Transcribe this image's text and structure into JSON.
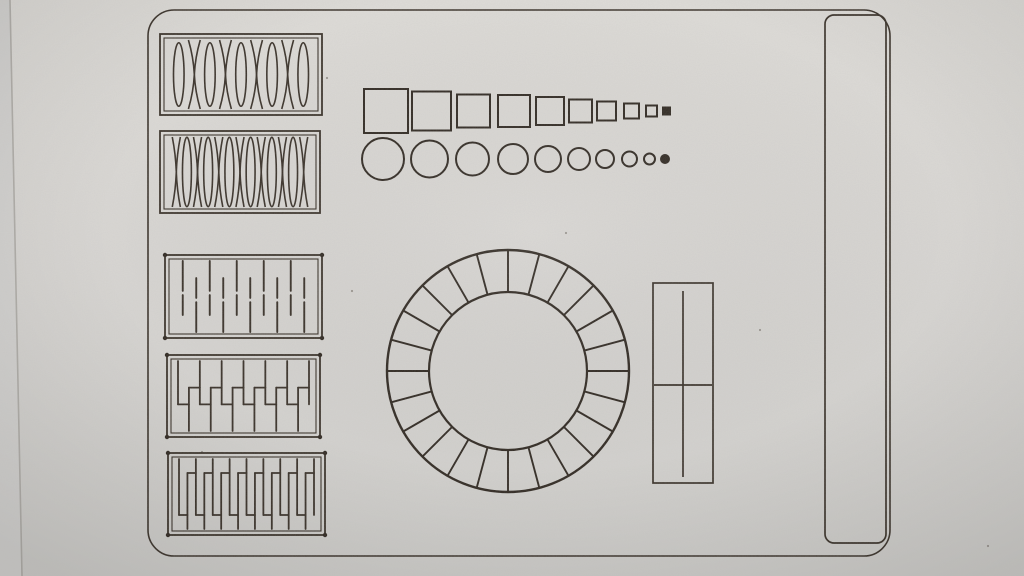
{
  "meta": {
    "description": "Photograph of a laser-cut and engraved calibration test sheet on light grey material: five living-hinge test panels, rows of shrinking squares and circles, a 24-segment ring, a divided rectangle and a tall rounded rectangle",
    "colors": {
      "material_top": "#dedcd8",
      "material_mid": "#d8d6d3",
      "material_bottom": "#cfcecb",
      "outside_strip": "#d4d3d1",
      "edge_line": "#a8a5a0",
      "line": "#3a322a",
      "line_bold": "#312a23",
      "speck": "#8a857e"
    }
  },
  "scene": {
    "canvas": {
      "width": 1024,
      "height": 576
    },
    "photo": {
      "sheet_edge": {
        "top_x": 10,
        "bottom_x": 22
      },
      "specks": [
        {
          "x": 327,
          "y": 78
        },
        {
          "x": 202,
          "y": 452
        },
        {
          "x": 566,
          "y": 233
        },
        {
          "x": 352,
          "y": 291
        },
        {
          "x": 760,
          "y": 330
        },
        {
          "x": 988,
          "y": 546
        }
      ]
    },
    "board": {
      "x": 148,
      "y": 10,
      "width": 742,
      "height": 546,
      "radius": 26,
      "stroke_width": 1.6
    },
    "left_column": {
      "hinge_panels": [
        {
          "name": "hinge-panel-ellipse-cross",
          "pattern": "ellipse-cross",
          "x": 160,
          "y": 34,
          "width": 162,
          "height": 81,
          "units": 9,
          "corner_dots": false
        },
        {
          "name": "hinge-panel-cross-ellipse",
          "pattern": "cross-ellipse",
          "x": 160,
          "y": 131,
          "width": 160,
          "height": 82,
          "units": 13,
          "corner_dots": false
        },
        {
          "name": "hinge-panel-dashed-lines",
          "pattern": "dashes",
          "x": 165,
          "y": 255,
          "width": 157,
          "height": 83,
          "units": 10,
          "corner_dots": true
        },
        {
          "name": "hinge-panel-serpentine",
          "pattern": "serpentine",
          "x": 167,
          "y": 355,
          "width": 153,
          "height": 82,
          "units": 13,
          "reach": 0.62,
          "corner_dots": true
        },
        {
          "name": "hinge-panel-serpentine-dense",
          "pattern": "serpentine",
          "x": 168,
          "y": 453,
          "width": 157,
          "height": 82,
          "units": 17,
          "reach": 0.8,
          "corner_dots": true
        }
      ]
    },
    "top_middle": {
      "squares_row": {
        "center_y": 111,
        "items": [
          {
            "x": 364,
            "size": 44,
            "filled": false
          },
          {
            "x": 412,
            "size": 39,
            "filled": false
          },
          {
            "x": 457,
            "size": 33,
            "filled": false
          },
          {
            "x": 498,
            "size": 32,
            "filled": false
          },
          {
            "x": 536,
            "size": 28,
            "filled": false
          },
          {
            "x": 569,
            "size": 23,
            "filled": false
          },
          {
            "x": 597,
            "size": 19,
            "filled": false
          },
          {
            "x": 624,
            "size": 15,
            "filled": false
          },
          {
            "x": 646,
            "size": 11,
            "filled": false
          },
          {
            "x": 663,
            "size": 7,
            "filled": true
          }
        ]
      },
      "circles_row": {
        "center_y": 159,
        "items": [
          {
            "x": 362,
            "size": 42,
            "filled": false
          },
          {
            "x": 411,
            "size": 37,
            "filled": false
          },
          {
            "x": 456,
            "size": 33,
            "filled": false
          },
          {
            "x": 498,
            "size": 30,
            "filled": false
          },
          {
            "x": 535,
            "size": 26,
            "filled": false
          },
          {
            "x": 568,
            "size": 22,
            "filled": false
          },
          {
            "x": 596,
            "size": 18,
            "filled": false
          },
          {
            "x": 622,
            "size": 15,
            "filled": false
          },
          {
            "x": 644,
            "size": 11,
            "filled": false
          },
          {
            "x": 661,
            "size": 8,
            "filled": true
          }
        ]
      }
    },
    "center": {
      "segmented_ring": {
        "cx": 508,
        "cy": 371,
        "outer_r": 121,
        "inner_r": 79,
        "segments": 24
      }
    },
    "right_of_ring": {
      "divided_rect": {
        "x": 653,
        "y": 283,
        "width": 60,
        "height": 200,
        "v_line_x": 683,
        "v_line_y1": 291,
        "v_line_y2": 477,
        "h_line_y": 385,
        "h_line_x1": 654,
        "h_line_x2": 712
      }
    },
    "right_column": {
      "tall_rounded_rect": {
        "x": 825,
        "y": 15,
        "width": 61,
        "height": 528,
        "radius": 9
      }
    }
  }
}
